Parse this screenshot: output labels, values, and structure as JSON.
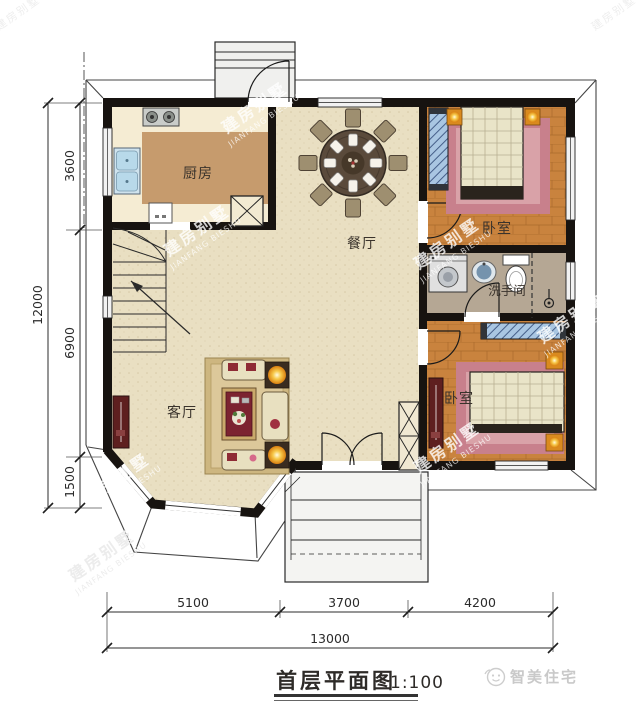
{
  "title": {
    "name": "首层平面图",
    "scale": "1:100"
  },
  "brand": {
    "name": "智美住宅"
  },
  "watermark": {
    "cn": "建房别墅",
    "en": "JIANFANG BIESHU"
  },
  "rooms": {
    "kitchen": "厨房",
    "dining": "餐厅",
    "living": "客厅",
    "bedroom_top": "卧室",
    "bedroom_bottom": "卧室",
    "bathroom": "洗手间"
  },
  "dimensions": {
    "left": {
      "segments": [
        "3600",
        "6900",
        "1500"
      ],
      "total": "12000"
    },
    "bottom": {
      "segments": [
        "5100",
        "3700",
        "4200"
      ],
      "total": "13000"
    }
  },
  "colors": {
    "wall": "#171310",
    "floor_main": "#e9dfc2",
    "kitchen_counter": "#f5ecd3",
    "kitchen_floor": "#c69b6d",
    "bedroom_floor": "#c9833e",
    "bathroom_floor": "#b5a794",
    "rug_pink": "#c8808c",
    "wardrobe_blue": "#a9c6e2",
    "accent_maroon": "#5e1f1f",
    "lamp_gold": "#f0a818"
  }
}
